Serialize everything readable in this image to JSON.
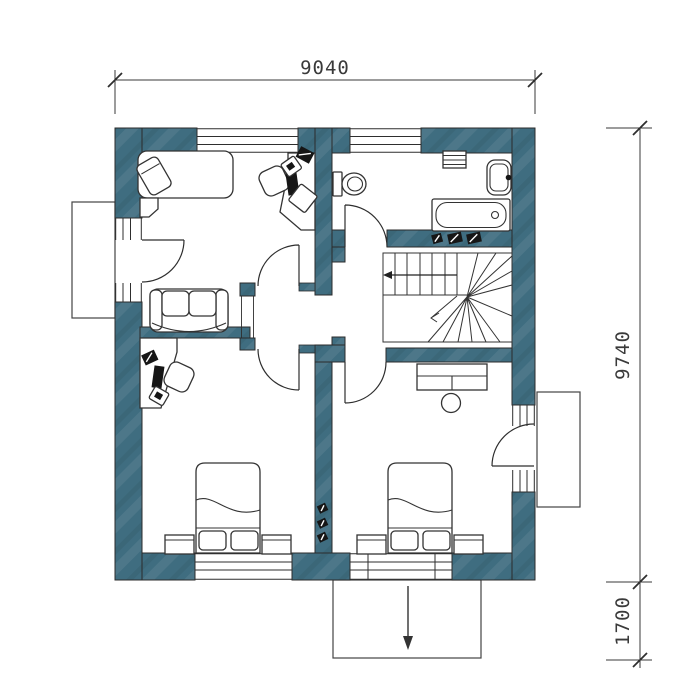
{
  "page": {
    "type": "architectural-floor-plan",
    "view": "upper-floor-plan"
  },
  "dimensions": {
    "top": "9040",
    "right": "9740",
    "porch": "1700"
  },
  "colors": {
    "wall": "#3f6d80",
    "line": "#2b2b2b",
    "bg": "#ffffff",
    "furndark": "#161616"
  },
  "symbols": [
    "single-bed",
    "pillow",
    "bedside-table",
    "corner-desk",
    "office-chair",
    "monitor",
    "printer",
    "sofa",
    "double-bed",
    "nightstand",
    "dresser",
    "stool",
    "toilet",
    "bathtub",
    "sink",
    "radiator",
    "winder-staircase",
    "stair-direction-arrow",
    "balcony",
    "porch",
    "entry-arrow",
    "wall-vent",
    "switch"
  ]
}
